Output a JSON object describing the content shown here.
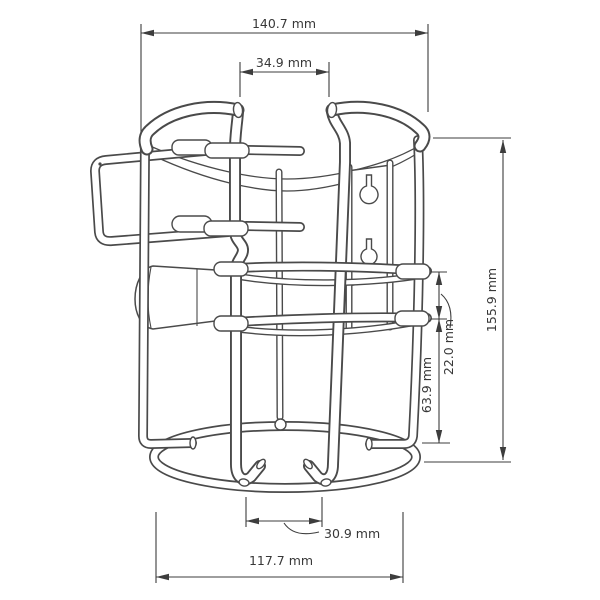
{
  "page": {
    "background": "#ffffff"
  },
  "drawing": {
    "type": "technical-dimension-drawing",
    "subject": "wire-form wall-mount holder bracket, perspective line drawing",
    "unit": "mm",
    "line_color": "#4a4a4a",
    "dimension_color": "#3d3d3d",
    "features": [
      "top-rim",
      "bottom-ring",
      "mounting-plate-with-two-keyhole-slots",
      "latch-bail",
      "latch-pad",
      "front-hook-wires",
      "mid-bands"
    ],
    "dims": {
      "overall_width": "140.7 mm",
      "top_opening": "34.9 mm",
      "overall_height": "155.9 mm",
      "band_spacing": "22.0 mm",
      "band_to_base": "63.9 mm",
      "front_opening": "30.9 mm",
      "base_width": "117.7 mm"
    }
  }
}
